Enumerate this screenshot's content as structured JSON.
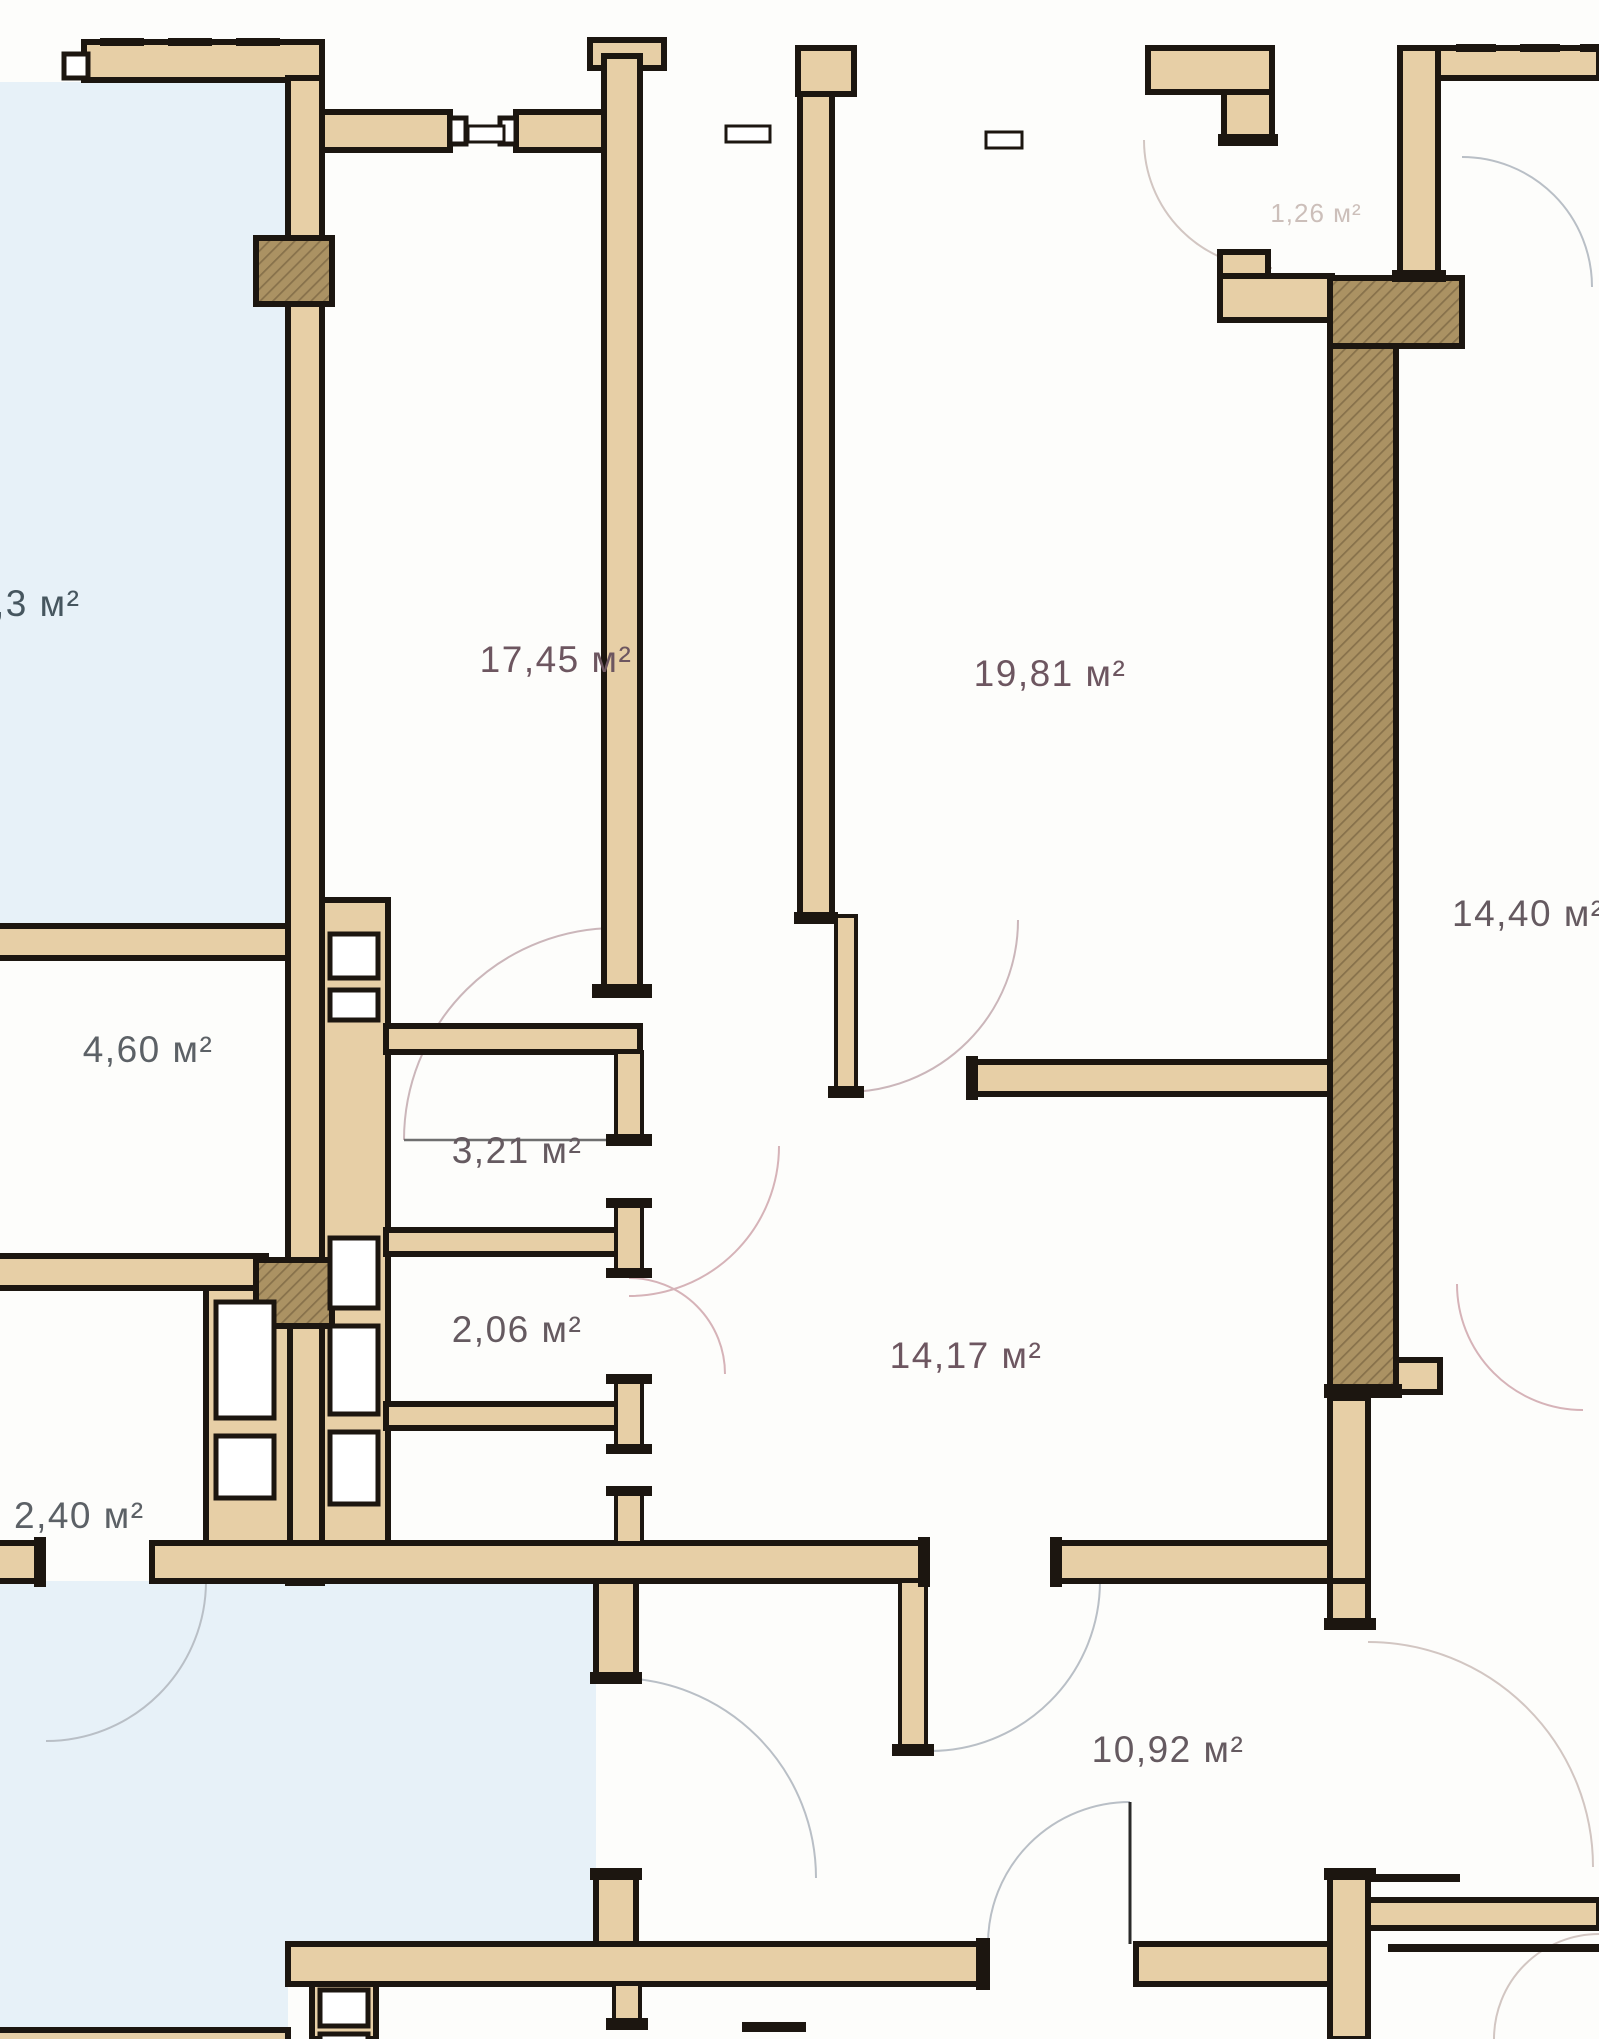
{
  "plan": {
    "kind": "apartment-floor-plan",
    "units": "м²",
    "colors": {
      "background": "#fdfdfb",
      "neighbor_area": "#e7f1f8",
      "wall_fill": "#e7cfa6",
      "wall_outline": "#1c1610",
      "structural_column": "#ab9263",
      "label_default": "#655a60",
      "label_faint": "#ccbfba",
      "door_arc_pink": "#d6b3b8",
      "door_arc_gray": "#b9bfc6"
    },
    "rooms": [
      {
        "key": "neighbor-left-room",
        "area_label": ",3 м²"
      },
      {
        "key": "room-17-45",
        "area_label": "17,45 м²"
      },
      {
        "key": "room-19-81",
        "area_label": "19,81 м²"
      },
      {
        "key": "entry-1-26",
        "area_label": "1,26 м²"
      },
      {
        "key": "room-right-14-40",
        "area_label": "14,40 м²"
      },
      {
        "key": "room-4-60",
        "area_label": "4,60 м²"
      },
      {
        "key": "room-3-21",
        "area_label": "3,21 м²"
      },
      {
        "key": "room-2-06",
        "area_label": "2,06 м²"
      },
      {
        "key": "room-2-40",
        "area_label": "2,40 м²"
      },
      {
        "key": "hallway-14-17",
        "area_label": "14,17 м²"
      },
      {
        "key": "corridor-10-92",
        "area_label": "10,92 м²"
      }
    ]
  }
}
